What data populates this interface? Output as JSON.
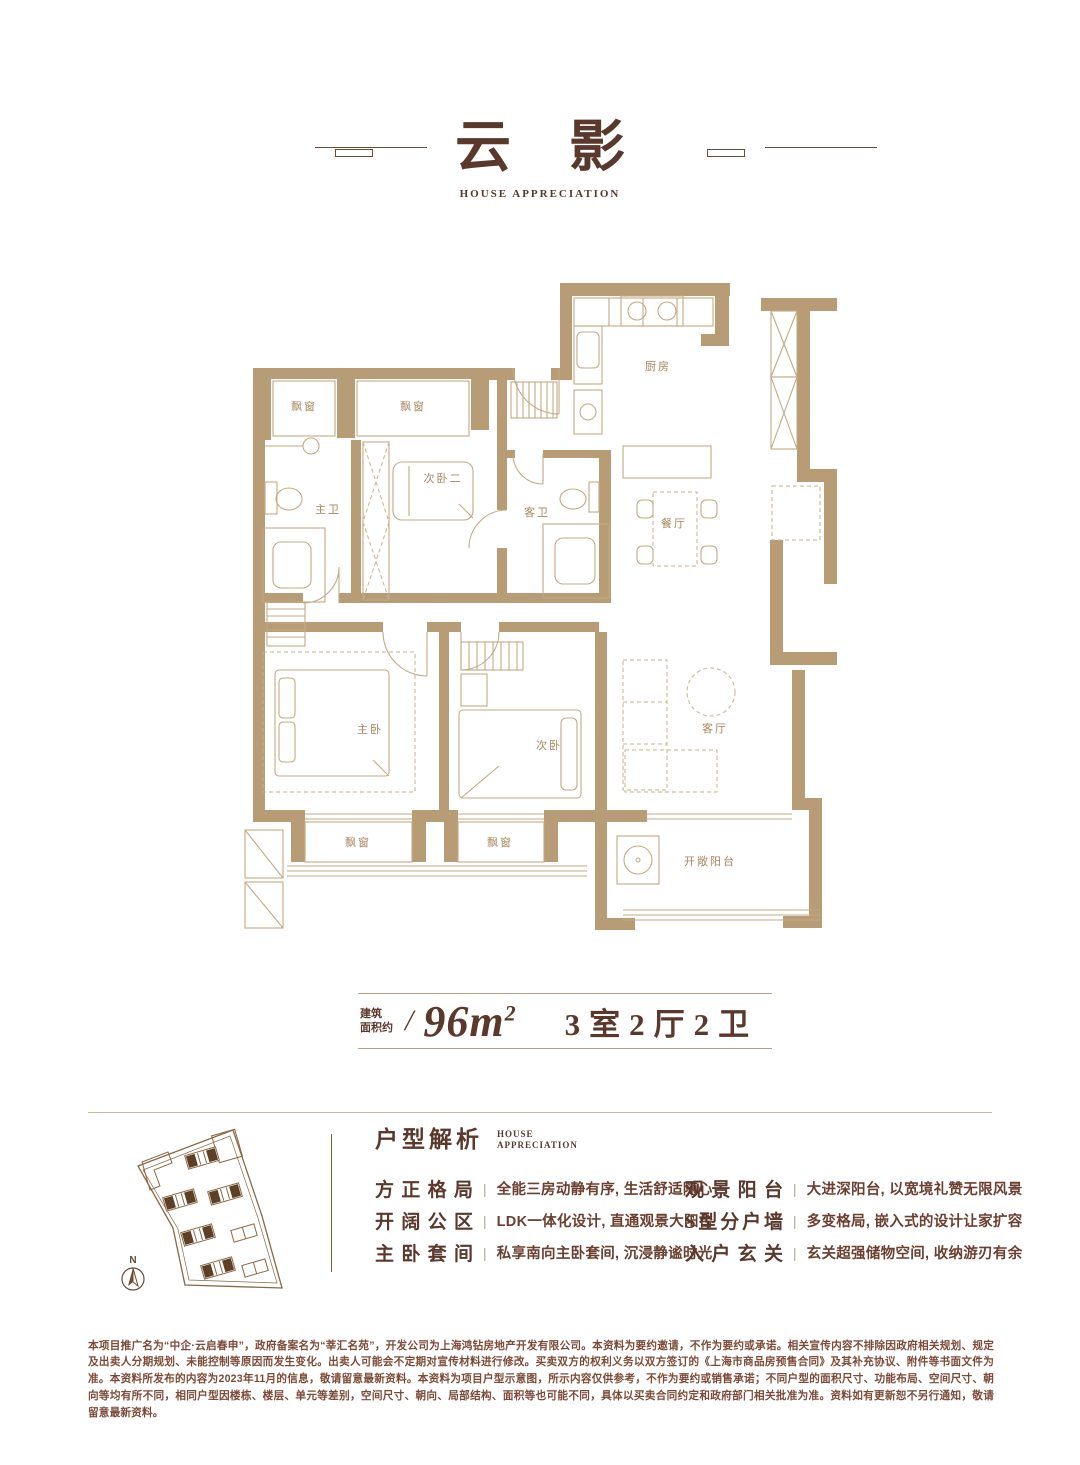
{
  "header": {
    "title": "云影",
    "subtitle": "HOUSE APPRECIATION"
  },
  "floorplan": {
    "rooms": {
      "bay_top_left": "飘窗",
      "bay_top_mid": "飘窗",
      "master_bath": "主卫",
      "bedroom_two": "次卧二",
      "guest_bath": "客卫",
      "kitchen": "厨房",
      "dining": "餐厅",
      "master_bedroom": "主卧",
      "second_bedroom": "次卧",
      "living": "客厅",
      "bay_bottom_left": "飘窗",
      "bay_bottom_mid": "飘窗",
      "balcony": "开敞阳台"
    }
  },
  "site_plan": {
    "north_label": "N"
  },
  "area": {
    "prefix_line1": "建筑",
    "prefix_line2": "面积约",
    "slash": "/",
    "size_base": "96m",
    "size_sup": "2",
    "layout": "3室2厅2卫"
  },
  "analysis": {
    "title": "户型解析",
    "subtitle_line1": "HOUSE",
    "subtitle_line2": "APPRECIATION",
    "divider": "|",
    "left_items": [
      {
        "term": "方正格局",
        "desc": "全能三房动静有序, 生活舒适随心"
      },
      {
        "term": "开阔公区",
        "desc": "LDK一体化设计, 直通观景大阳台"
      },
      {
        "term": "主卧套间",
        "desc": "私享南向主卧套间, 沉浸静谧时光"
      }
    ],
    "right_items": [
      {
        "term": "观景阳台",
        "desc": "大进深阳台, 以宽境礼赞无限风景"
      },
      {
        "term": "S型分户墙",
        "desc": "多变格局, 嵌入式的设计让家扩容"
      },
      {
        "term": "入户玄关",
        "desc": "玄关超强储物空间, 收纳游刃有余"
      }
    ]
  },
  "disclaimer": "本项目推广名为“中企·云启春申”，政府备案名为“莘汇名苑”，开发公司为上海鸿钻房地产开发有限公司。本资料为要约邀请，不作为要约或承诺。相关宣传内容不排除因政府相关规划、规定及出卖人分期规划、未能控制等原因而发生变化。出卖人可能会不定期对宣传材料进行修改。买卖双方的权利义务以双方签订的《上海市商品房预售合同》及其补充协议、附件等书面文件为准。本资料所发布的内容为2023年11月的信息，敬请留意最新资料。本资料为项目户型示意图，所示内容仅供参考，不作为要约或销售承诺；不同户型的面积尺寸、功能布局、空间尺寸、朝向等均有所不同，相同户型因楼栋、楼层、单元等差别，空间尺寸、朝向、局部结构、面积等也可能不同，具体以买卖合同约定和政府部门相关批准为准。资料如有更新恕不另行通知，敬请留意最新资料。"
}
